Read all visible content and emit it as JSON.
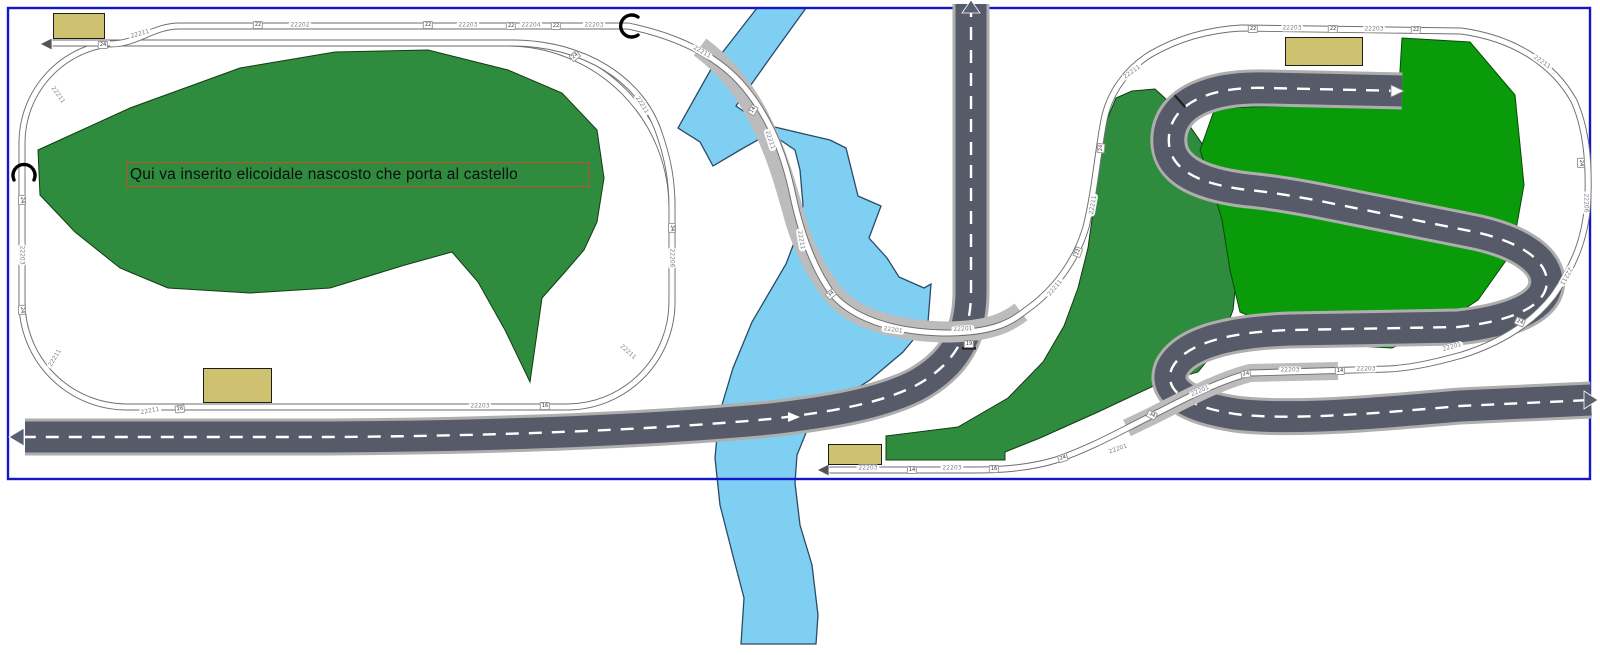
{
  "annotation": {
    "text": "Qui va inserito elicoidale nascosto che porta al castello",
    "border_color": "#c0512c"
  },
  "colors": {
    "layout_border": "#1616c8",
    "hill_green": "#2f8b3d",
    "bright_green": "#0a9b0b",
    "water_fill": "#7fcff2",
    "water_outline": "#2a4a66",
    "road_asphalt": "#575b69",
    "road_edge": "#aeaeae",
    "ballast": "#bcbcbc",
    "building_fill": "#cec271"
  },
  "buildings": [
    {
      "x": 53,
      "y": 13,
      "w": 50,
      "h": 24
    },
    {
      "x": 203,
      "y": 368,
      "w": 67,
      "h": 33
    },
    {
      "x": 1285,
      "y": 37,
      "w": 76,
      "h": 27
    },
    {
      "x": 828,
      "y": 444,
      "w": 52,
      "h": 19
    }
  ],
  "track_labels": [
    {
      "text": "22202",
      "x": 300,
      "y": 25,
      "rot": 0
    },
    {
      "text": "22203",
      "x": 468,
      "y": 25,
      "rot": 0
    },
    {
      "text": "22204",
      "x": 531,
      "y": 25,
      "rot": 0
    },
    {
      "text": "22203",
      "x": 594,
      "y": 25,
      "rot": 0
    },
    {
      "text": "22211",
      "x": 140,
      "y": 34,
      "rot": -16
    },
    {
      "text": "22211",
      "x": 58,
      "y": 95,
      "rot": 55
    },
    {
      "text": "22203",
      "x": 22,
      "y": 255,
      "rot": 90
    },
    {
      "text": "22211",
      "x": 55,
      "y": 358,
      "rot": -58
    },
    {
      "text": "22211",
      "x": 150,
      "y": 411,
      "rot": -10
    },
    {
      "text": "22203",
      "x": 480,
      "y": 406,
      "rot": 0
    },
    {
      "text": "22211",
      "x": 628,
      "y": 352,
      "rot": 42
    },
    {
      "text": "22206",
      "x": 672,
      "y": 258,
      "rot": 90
    },
    {
      "text": "22211",
      "x": 642,
      "y": 105,
      "rot": 58
    },
    {
      "text": "22211",
      "x": 702,
      "y": 52,
      "rot": 30
    },
    {
      "text": "22211",
      "x": 770,
      "y": 140,
      "rot": 72
    },
    {
      "text": "22211",
      "x": 801,
      "y": 240,
      "rot": 80
    },
    {
      "text": "22201",
      "x": 893,
      "y": 330,
      "rot": 8
    },
    {
      "text": "22201",
      "x": 963,
      "y": 329,
      "rot": -3
    },
    {
      "text": "22211",
      "x": 1055,
      "y": 288,
      "rot": -50
    },
    {
      "text": "22211",
      "x": 1093,
      "y": 205,
      "rot": -80
    },
    {
      "text": "22211",
      "x": 1132,
      "y": 72,
      "rot": -36
    },
    {
      "text": "22203",
      "x": 1292,
      "y": 28,
      "rot": 0
    },
    {
      "text": "22203",
      "x": 1374,
      "y": 29,
      "rot": 0
    },
    {
      "text": "22211",
      "x": 1542,
      "y": 62,
      "rot": 34
    },
    {
      "text": "22206",
      "x": 1586,
      "y": 203,
      "rot": 90
    },
    {
      "text": "22211",
      "x": 1566,
      "y": 276,
      "rot": 118
    },
    {
      "text": "22201",
      "x": 1452,
      "y": 347,
      "rot": -16
    },
    {
      "text": "22203",
      "x": 1290,
      "y": 370,
      "rot": 0
    },
    {
      "text": "22203",
      "x": 1366,
      "y": 369,
      "rot": 0
    },
    {
      "text": "22201",
      "x": 1200,
      "y": 391,
      "rot": -24
    },
    {
      "text": "22201",
      "x": 1118,
      "y": 449,
      "rot": -20
    },
    {
      "text": "22203",
      "x": 868,
      "y": 468,
      "rot": 0
    },
    {
      "text": "22203",
      "x": 952,
      "y": 468,
      "rot": 0
    }
  ],
  "joint_labels": [
    {
      "text": "24",
      "x": 103,
      "y": 45,
      "rot": 0
    },
    {
      "text": "22",
      "x": 258,
      "y": 25,
      "rot": 0
    },
    {
      "text": "22",
      "x": 428,
      "y": 25,
      "rot": 0
    },
    {
      "text": "22",
      "x": 511,
      "y": 26,
      "rot": 0
    },
    {
      "text": "22",
      "x": 556,
      "y": 26,
      "rot": 0
    },
    {
      "text": "24",
      "x": 22,
      "y": 200,
      "rot": 90
    },
    {
      "text": "24",
      "x": 22,
      "y": 310,
      "rot": 90
    },
    {
      "text": "26",
      "x": 180,
      "y": 409,
      "rot": -6
    },
    {
      "text": "16",
      "x": 545,
      "y": 406,
      "rot": 0
    },
    {
      "text": "34",
      "x": 672,
      "y": 228,
      "rot": 90
    },
    {
      "text": "24",
      "x": 575,
      "y": 56,
      "rot": -38
    },
    {
      "text": "14",
      "x": 753,
      "y": 110,
      "rot": -60
    },
    {
      "text": "34",
      "x": 831,
      "y": 294,
      "rot": -40
    },
    {
      "text": "19",
      "x": 969,
      "y": 344,
      "rot": 0
    },
    {
      "text": "22",
      "x": 1078,
      "y": 252,
      "rot": -70
    },
    {
      "text": "24",
      "x": 1101,
      "y": 148,
      "rot": -85
    },
    {
      "text": "22",
      "x": 1253,
      "y": 29,
      "rot": 0
    },
    {
      "text": "22",
      "x": 1333,
      "y": 29,
      "rot": 0
    },
    {
      "text": "22",
      "x": 1416,
      "y": 30,
      "rot": 0
    },
    {
      "text": "24",
      "x": 1581,
      "y": 163,
      "rot": 90
    },
    {
      "text": "24",
      "x": 1520,
      "y": 322,
      "rot": 24
    },
    {
      "text": "14",
      "x": 1340,
      "y": 371,
      "rot": 0
    },
    {
      "text": "24",
      "x": 1246,
      "y": 374,
      "rot": -6
    },
    {
      "text": "34",
      "x": 1152,
      "y": 415,
      "rot": 26
    },
    {
      "text": "14",
      "x": 912,
      "y": 470,
      "rot": 0
    },
    {
      "text": "16",
      "x": 994,
      "y": 469,
      "rot": 0
    },
    {
      "text": "24",
      "x": 1063,
      "y": 458,
      "rot": -18
    }
  ]
}
